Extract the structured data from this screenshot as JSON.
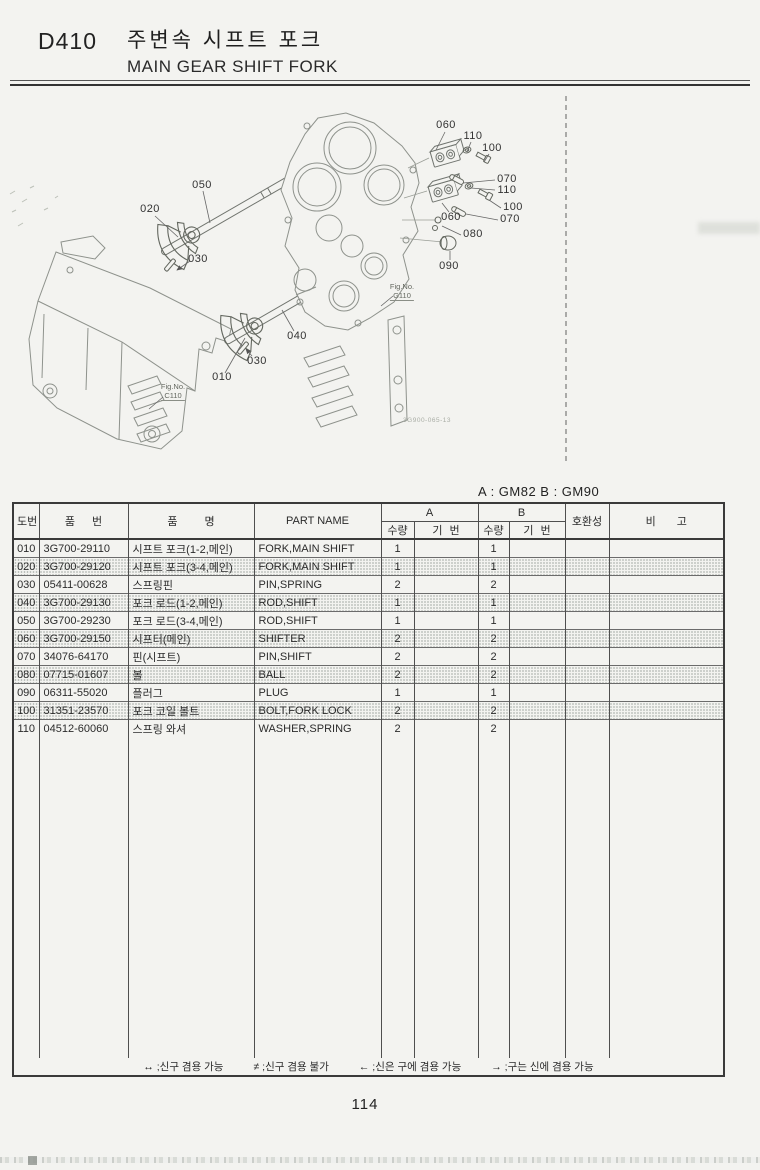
{
  "header": {
    "code": "D410",
    "title_kr": "주변속 시프트 포크",
    "title_en": "MAIN GEAR SHIFT FORK"
  },
  "diagram": {
    "callouts": [
      "050",
      "020",
      "030",
      "040",
      "030",
      "010",
      "060",
      "110",
      "100",
      "070",
      "110",
      "100",
      "070",
      "060",
      "080",
      "090"
    ],
    "fig_ref_g": {
      "line1": "Fig.No.",
      "line2": "G110"
    },
    "fig_ref_c": {
      "line1": "Fig.No.",
      "line2": "C110"
    },
    "plate_code": "3G900-065-13"
  },
  "table": {
    "ab_note": "A : GM82   B : GM90",
    "headers": {
      "no": "도번",
      "part_no": "품 번",
      "name_kr": "품 명",
      "part_name": "PART NAME",
      "group_a": "A",
      "group_b": "B",
      "qty": "수량",
      "ref": "기 번",
      "compat": "호환성",
      "remarks": "비 고"
    },
    "rows": [
      {
        "no": "010",
        "part_no": "3G700-29110",
        "name_kr": "시프트 포크(1-2,메인)",
        "part_name": "FORK,MAIN SHIFT",
        "qty_a": "1",
        "ref_a": "",
        "qty_b": "1",
        "ref_b": "",
        "compat": "",
        "remarks": "",
        "shaded": false
      },
      {
        "no": "020",
        "part_no": "3G700-29120",
        "name_kr": "시프트 포크(3-4,메인)",
        "part_name": "FORK,MAIN SHIFT",
        "qty_a": "1",
        "ref_a": "",
        "qty_b": "1",
        "ref_b": "",
        "compat": "",
        "remarks": "",
        "shaded": true
      },
      {
        "no": "030",
        "part_no": "05411-00628",
        "name_kr": "스프링핀",
        "part_name": "PIN,SPRING",
        "qty_a": "2",
        "ref_a": "",
        "qty_b": "2",
        "ref_b": "",
        "compat": "",
        "remarks": "",
        "shaded": false
      },
      {
        "no": "040",
        "part_no": "3G700-29130",
        "name_kr": "포크 로드(1-2,메인)",
        "part_name": "ROD,SHIFT",
        "qty_a": "1",
        "ref_a": "",
        "qty_b": "1",
        "ref_b": "",
        "compat": "",
        "remarks": "",
        "shaded": true
      },
      {
        "no": "050",
        "part_no": "3G700-29230",
        "name_kr": "포크 로드(3-4,메인)",
        "part_name": "ROD,SHIFT",
        "qty_a": "1",
        "ref_a": "",
        "qty_b": "1",
        "ref_b": "",
        "compat": "",
        "remarks": "",
        "shaded": false
      },
      {
        "no": "060",
        "part_no": "3G700-29150",
        "name_kr": "시프터(메인)",
        "part_name": "SHIFTER",
        "qty_a": "2",
        "ref_a": "",
        "qty_b": "2",
        "ref_b": "",
        "compat": "",
        "remarks": "",
        "shaded": true
      },
      {
        "no": "070",
        "part_no": "34076-64170",
        "name_kr": "핀(시프트)",
        "part_name": "PIN,SHIFT",
        "qty_a": "2",
        "ref_a": "",
        "qty_b": "2",
        "ref_b": "",
        "compat": "",
        "remarks": "",
        "shaded": false
      },
      {
        "no": "080",
        "part_no": "07715-01607",
        "name_kr": "볼",
        "part_name": "BALL",
        "qty_a": "2",
        "ref_a": "",
        "qty_b": "2",
        "ref_b": "",
        "compat": "",
        "remarks": "",
        "shaded": true
      },
      {
        "no": "090",
        "part_no": "06311-55020",
        "name_kr": "플러그",
        "part_name": "PLUG",
        "qty_a": "1",
        "ref_a": "",
        "qty_b": "1",
        "ref_b": "",
        "compat": "",
        "remarks": "",
        "shaded": false
      },
      {
        "no": "100",
        "part_no": "31351-23570",
        "name_kr": "포크 코일 볼트",
        "part_name": "BOLT,FORK LOCK",
        "qty_a": "2",
        "ref_a": "",
        "qty_b": "2",
        "ref_b": "",
        "compat": "",
        "remarks": "",
        "shaded": true
      },
      {
        "no": "110",
        "part_no": "04512-60060",
        "name_kr": "스프링 와셔",
        "part_name": "WASHER,SPRING",
        "qty_a": "2",
        "ref_a": "",
        "qty_b": "2",
        "ref_b": "",
        "compat": "",
        "remarks": "",
        "shaded": false
      }
    ],
    "legend": [
      "↔ ;신구 겸용 가능",
      "≠ ;신구 겸용 불가",
      "← ;신은 구에 겸용 가능",
      "→ ;구는 신에 겸용 가능"
    ]
  },
  "footer": {
    "page_number": "114"
  }
}
